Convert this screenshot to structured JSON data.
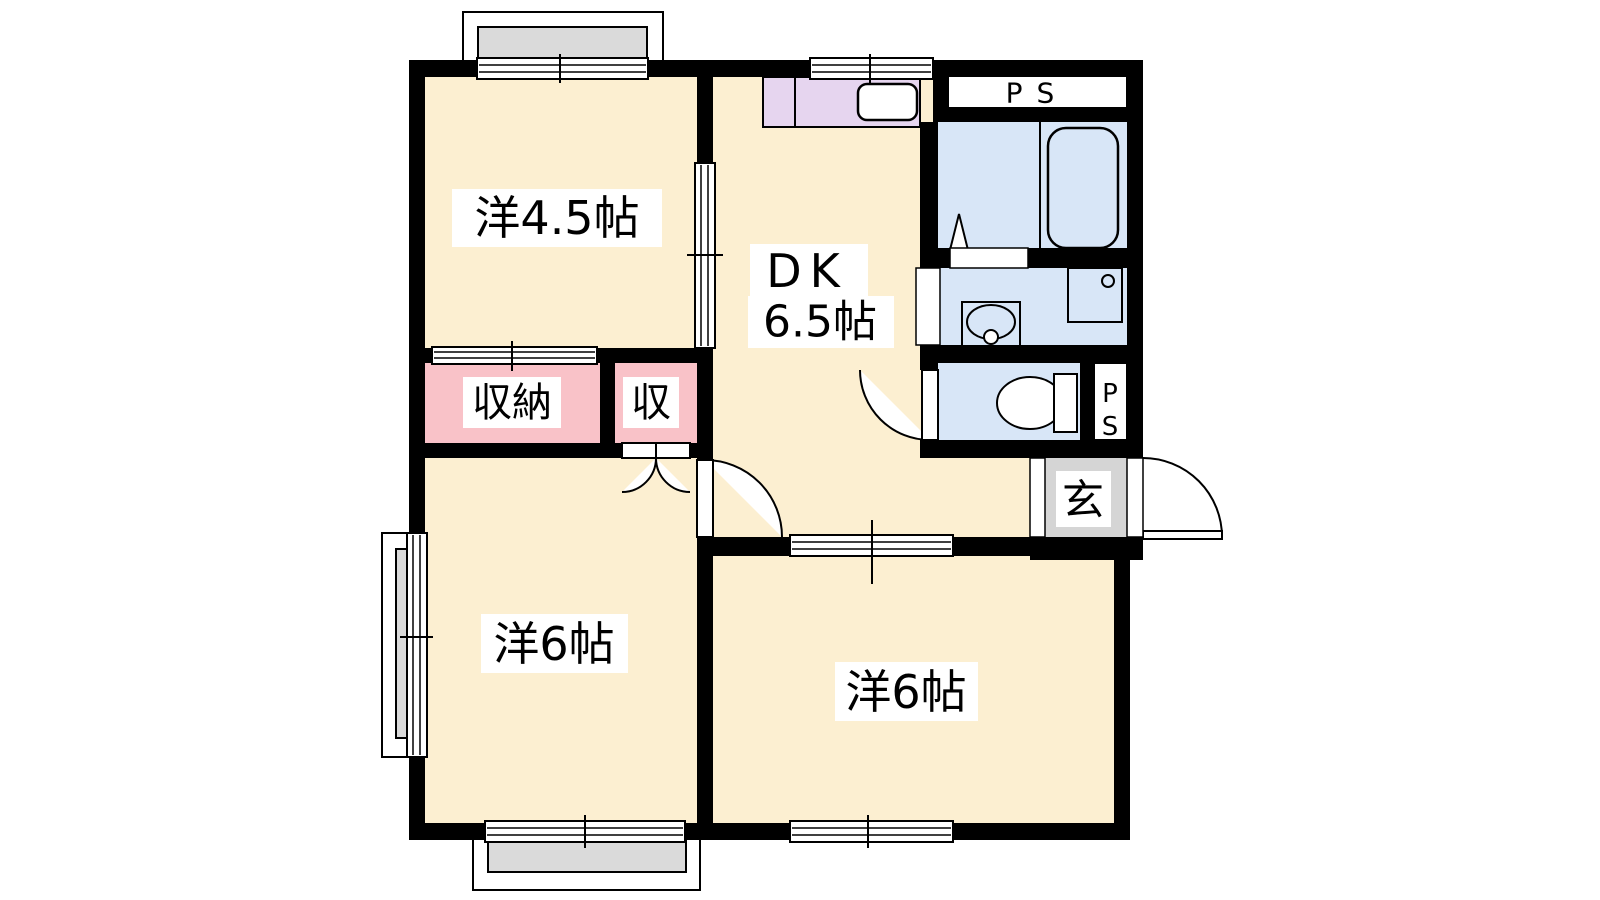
{
  "floorplan": {
    "labels": {
      "room_top_left": "洋4.5帖",
      "dk": "DK",
      "dk_size": "6.5帖",
      "closet_large": "収納",
      "closet_small": "収",
      "room_bottom_left": "洋6帖",
      "room_bottom_right": "洋6帖",
      "entrance": "玄",
      "ps_top": "PS",
      "ps_side_p": "P",
      "ps_side_s": "S"
    },
    "colors": {
      "wall": "#000000",
      "room_floor": "#FCEFD1",
      "kitchen_counter": "#E6D5EF",
      "wet_area": "#D8E6F7",
      "closet": "#F9C2C8",
      "entrance_floor": "#D5D5D5",
      "balcony": "#DADADA",
      "background": "#FFFFFF",
      "fixture_fill": "#FFFFFF"
    }
  }
}
